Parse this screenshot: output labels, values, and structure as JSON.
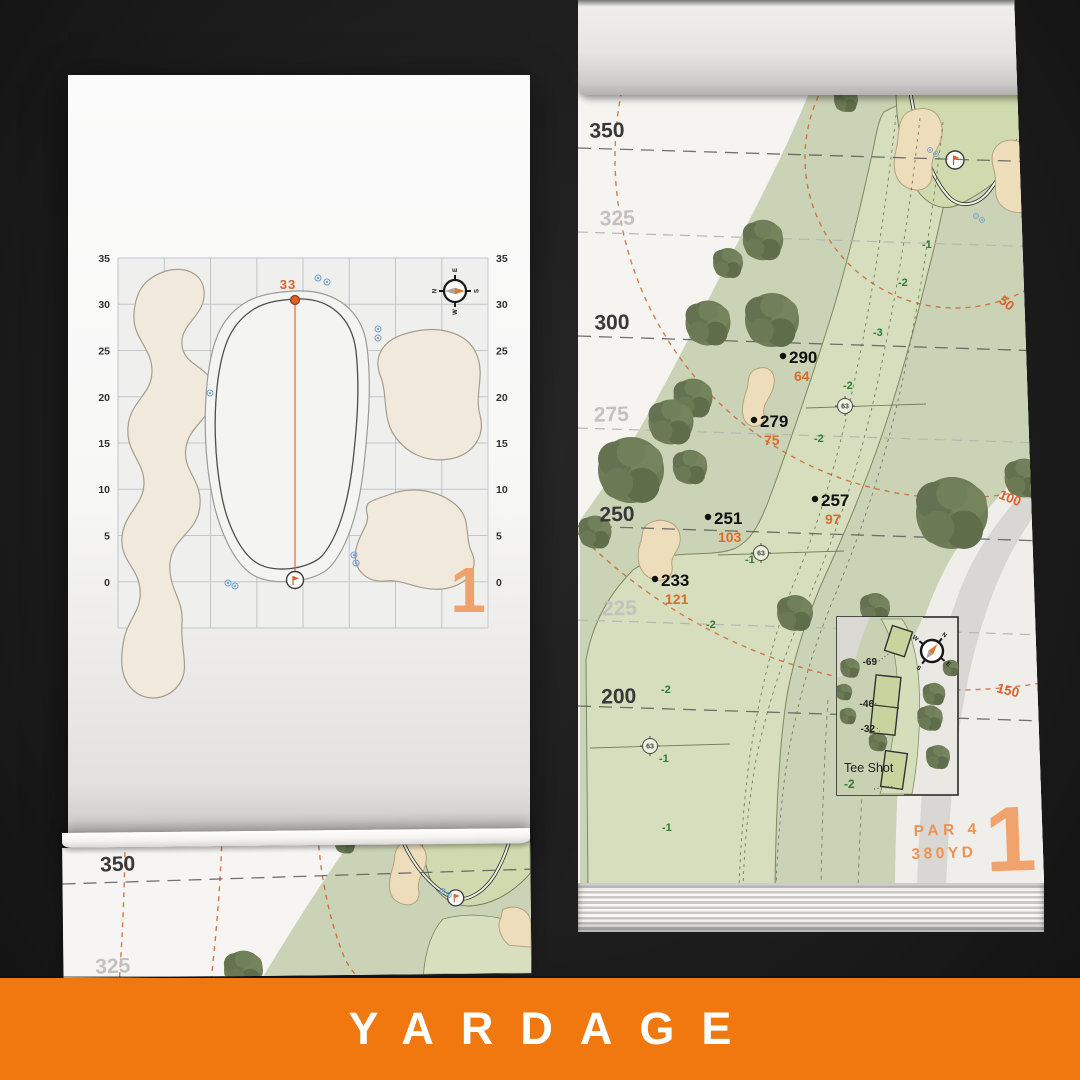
{
  "banner": {
    "title": "YARDAGE",
    "color": "#F1770F"
  },
  "colors": {
    "accent_orange": "#D9622A",
    "numeral_peach": "#F0A26E",
    "elevation_green": "#2E7A36",
    "fairway_green": "#D7DFBE",
    "rough_green": "#CBD3B6",
    "bunker_sand": "#EEDDBB"
  },
  "left_page": {
    "pin_distance": "33",
    "hole_number": "1",
    "axis": [
      "35",
      "30",
      "25",
      "20",
      "15",
      "10",
      "5",
      "0"
    ],
    "compass": {
      "n": "N",
      "e": "E",
      "s": "S",
      "w": "W"
    }
  },
  "right_page": {
    "hole_number": "1",
    "par": "PAR 4",
    "yardage": "380YD",
    "bands": [
      {
        "label": "350"
      },
      {
        "label": "325"
      },
      {
        "label": "300"
      },
      {
        "label": "275"
      },
      {
        "label": "250"
      },
      {
        "label": "225"
      },
      {
        "label": "200"
      }
    ],
    "arcs": [
      {
        "label": "50"
      },
      {
        "label": "100"
      },
      {
        "label": "150"
      }
    ],
    "points": [
      {
        "distance": "290",
        "to_pin": "64"
      },
      {
        "distance": "279",
        "to_pin": "75"
      },
      {
        "distance": "257",
        "to_pin": "97"
      },
      {
        "distance": "251",
        "to_pin": "103"
      },
      {
        "distance": "233",
        "to_pin": "121"
      }
    ],
    "widths": [
      "63",
      "63",
      "63"
    ],
    "elevations": [
      "-1",
      "-2",
      "-3",
      "-2",
      "-2",
      "-1",
      "-2",
      "-2",
      "-1",
      "-1"
    ],
    "tee_inset": {
      "title": "Tee Shot",
      "elevation": "-2",
      "markers": [
        "-69",
        "-46",
        "-32"
      ]
    },
    "compass": {
      "n": "N",
      "e": "E",
      "s": "S",
      "w": "W"
    }
  },
  "bottom_page": {
    "bands": [
      {
        "label": "350"
      },
      {
        "label": "325"
      }
    ]
  }
}
